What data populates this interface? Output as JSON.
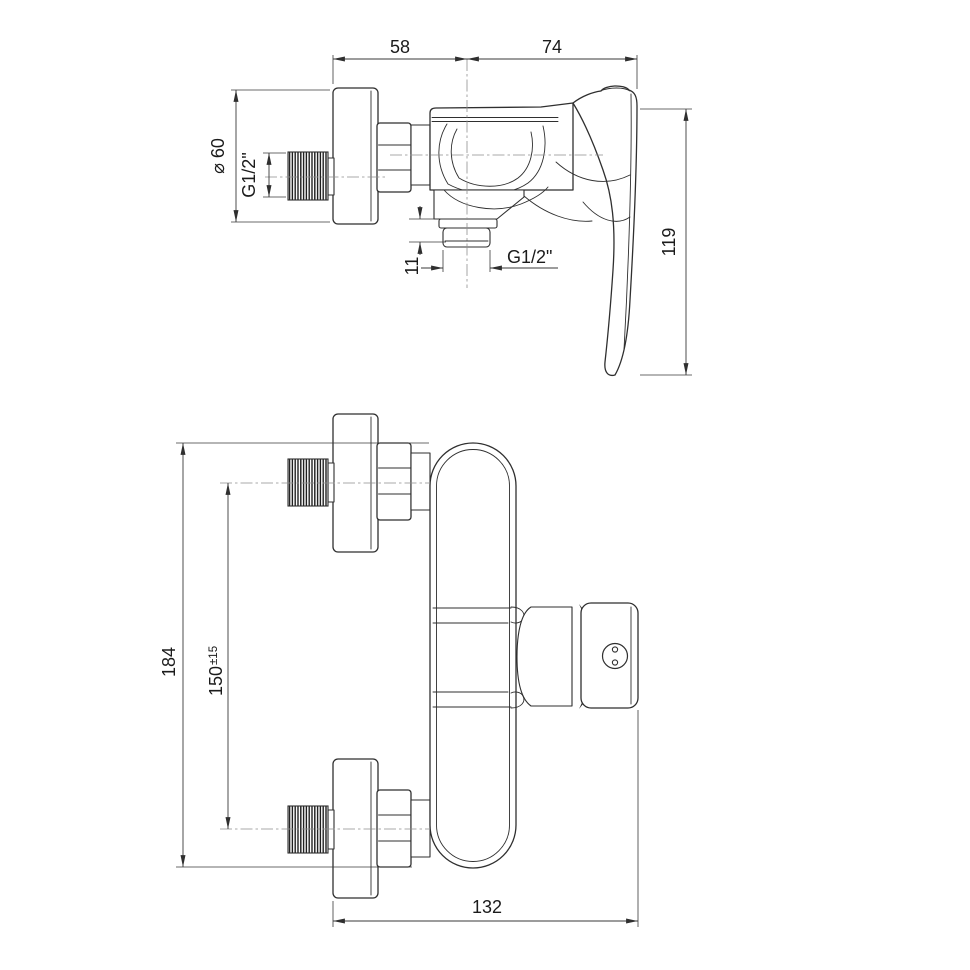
{
  "drawing": {
    "background_color": "#ffffff",
    "line_color": "#2f2f2f",
    "dimension_line_color": "#3a3a3a",
    "centerline_color": "#8f8f8f"
  },
  "side_view": {
    "dims": {
      "top_span_left": "58",
      "top_span_right": "74",
      "escutcheon_diameter": "⌀ 60",
      "inlet_thread": "G1/2\"",
      "outlet_stub_height": "11",
      "outlet_thread": "G1/2\"",
      "overall_height": "119"
    }
  },
  "front_view": {
    "dims": {
      "overall_height": "184",
      "port_spacing": "150",
      "port_spacing_tolerance": "±15",
      "overall_width": "132"
    }
  }
}
